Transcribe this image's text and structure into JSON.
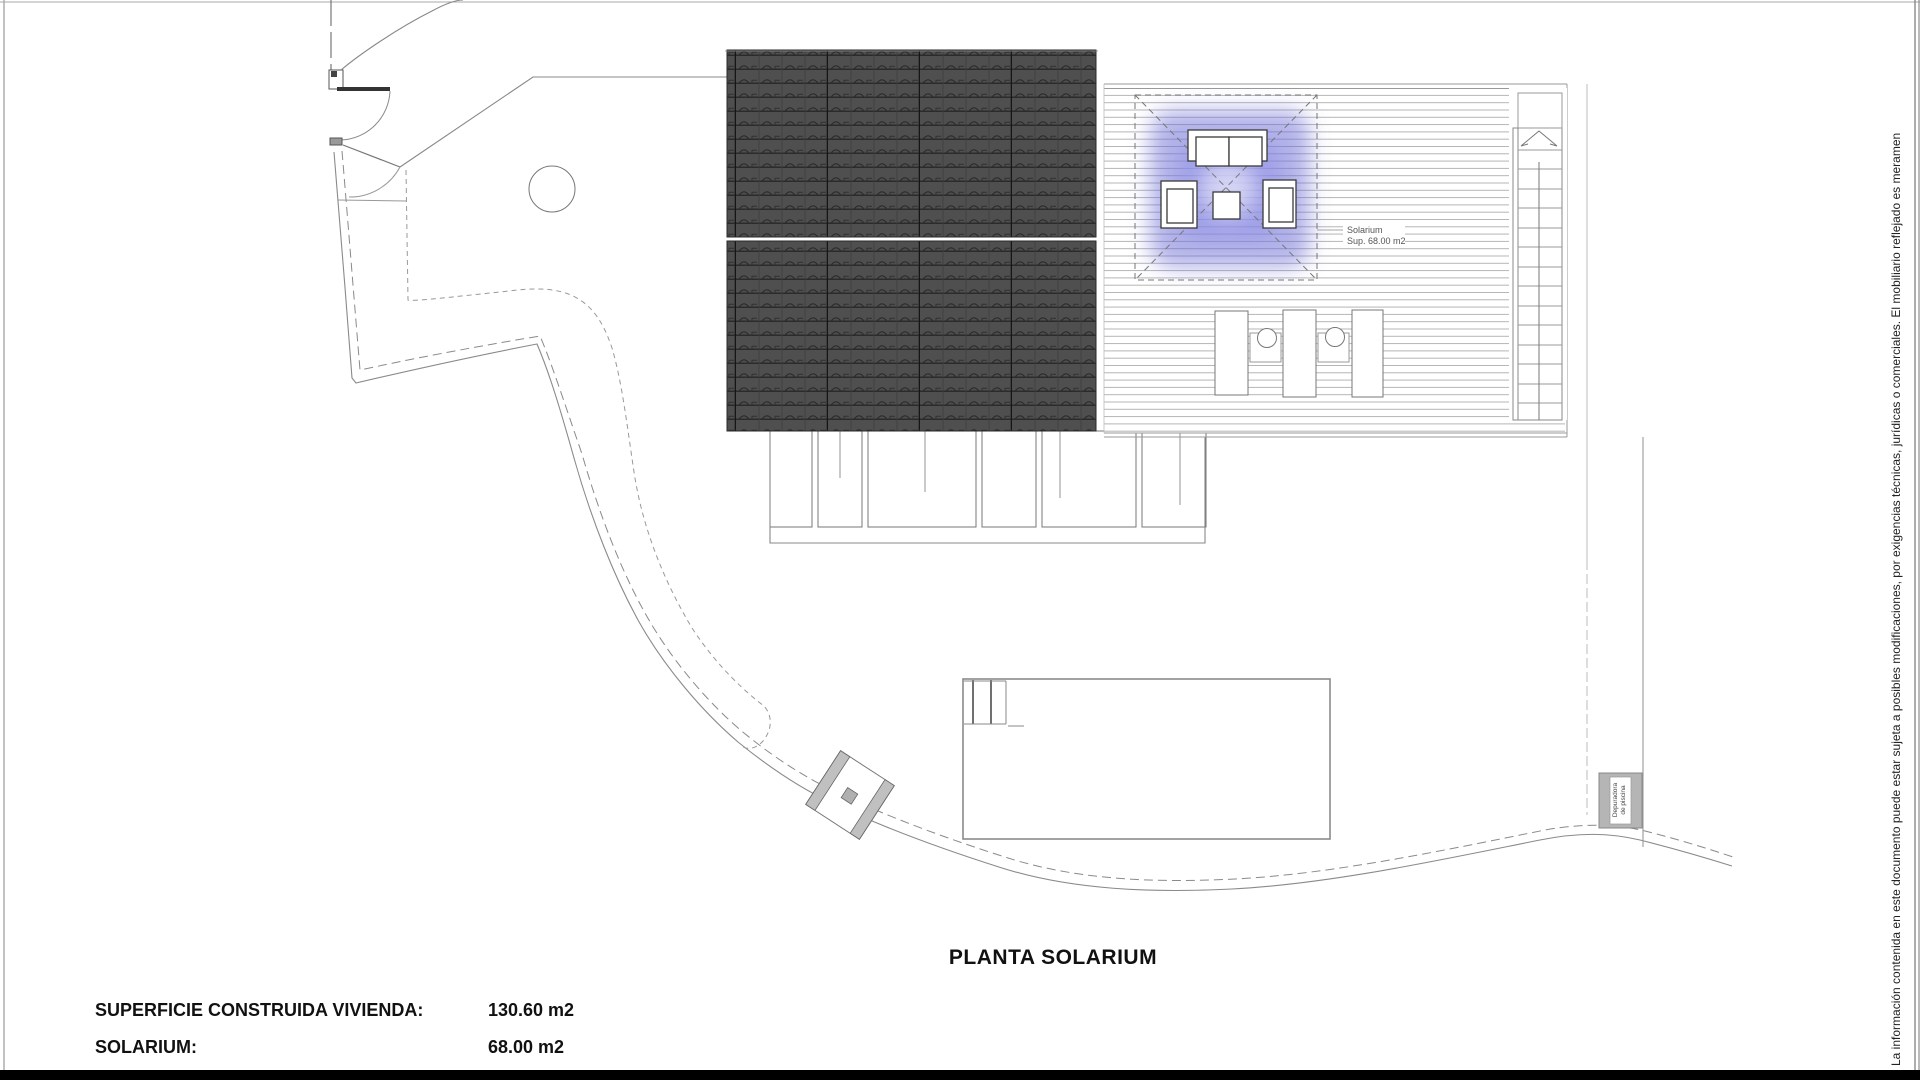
{
  "document": {
    "title": "PLANTA SOLARIUM",
    "measurements": [
      {
        "label": "SUPERFICIE CONSTRUIDA VIVIENDA:",
        "value": "130.60 m2"
      },
      {
        "label": "SOLARIUM:",
        "value": "68.00 m2"
      }
    ],
    "disclaimer": "La información contenida en este documento puede estar sujeta a posibles modificaciones, por exigencias técnicas, jurídicas o comerciales. El mobiliario reflejado es meramen"
  },
  "plan": {
    "annotations": {
      "solarium_label": {
        "line1": "Solarium",
        "line2": "Sup. 68.00 m2"
      },
      "pool_equipment": {
        "line1": "Depuradora",
        "line2": "de piscina"
      }
    },
    "colors": {
      "roof_fill": "#4f4f4f",
      "roof_tile_line": "#2b2b2b",
      "highlight_blue": "#6868d6",
      "drawing_line": "#8a8a8a",
      "deck_line": "#b4b4b4"
    }
  }
}
